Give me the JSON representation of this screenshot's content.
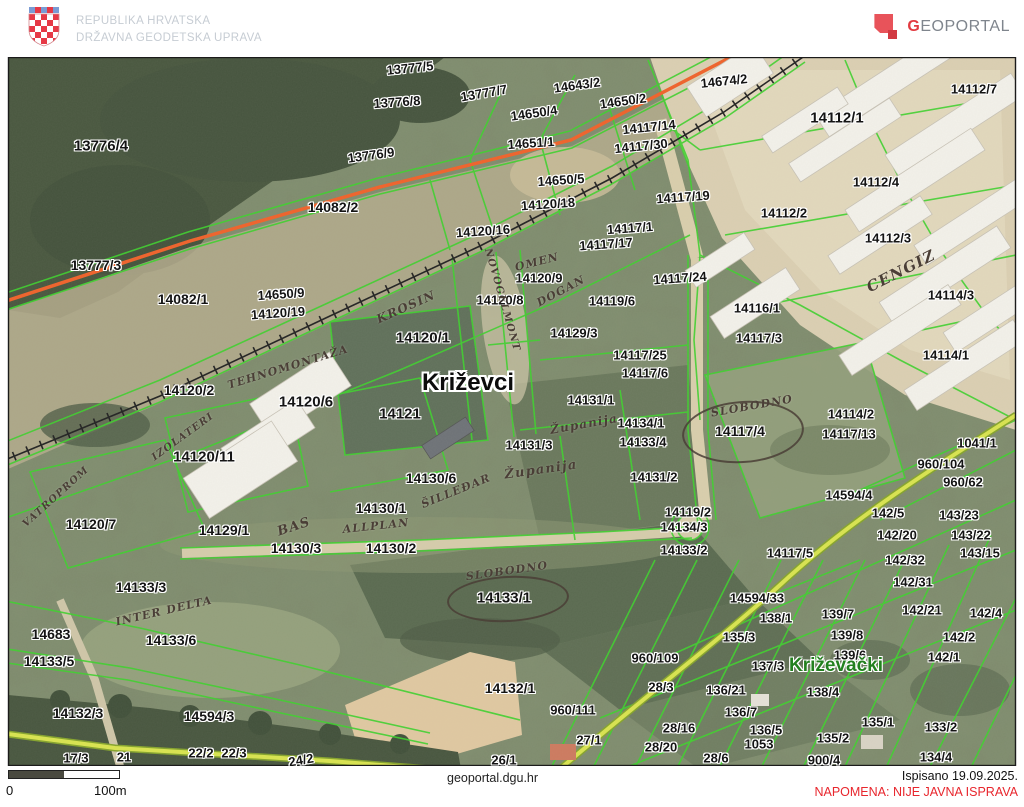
{
  "header": {
    "org_line1": "REPUBLIKA HRVATSKA",
    "org_line2": "DRŽAVNA GEODETSKA UPRAVA",
    "logo_text_leading": "G",
    "logo_text_rest": "EOPORTAL"
  },
  "map": {
    "colors": {
      "parcel_line": "#3fd12e",
      "highlight_road": "#d9e44f",
      "construction_line": "#f0622a",
      "settlement_text": "#23801f",
      "parcel_text": "#141414"
    },
    "labels": [
      {
        "t": "13777/5",
        "x": 410,
        "y": 68,
        "r": -6
      },
      {
        "t": "14643/2",
        "x": 577,
        "y": 85,
        "r": -8
      },
      {
        "t": "14674/2",
        "x": 724,
        "y": 81,
        "r": -6
      },
      {
        "t": "13776/8",
        "x": 397,
        "y": 102,
        "r": -4
      },
      {
        "t": "13777/7",
        "x": 484,
        "y": 93,
        "r": -10
      },
      {
        "t": "14650/4",
        "x": 534,
        "y": 113,
        "r": -8
      },
      {
        "t": "14650/2",
        "x": 623,
        "y": 101,
        "r": -8
      },
      {
        "t": "14112/7",
        "x": 974,
        "y": 89
      },
      {
        "t": "14117/14",
        "x": 649,
        "y": 127,
        "r": -6
      },
      {
        "t": "14112/1",
        "x": 837,
        "y": 118,
        "s": 15
      },
      {
        "t": "14651/1",
        "x": 531,
        "y": 143,
        "r": -4
      },
      {
        "t": "14117/30",
        "x": 641,
        "y": 146,
        "r": -6
      },
      {
        "t": "13776/4",
        "x": 101,
        "y": 146,
        "s": 15
      },
      {
        "t": "13776/9",
        "x": 371,
        "y": 155,
        "r": -8
      },
      {
        "t": "14650/5",
        "x": 561,
        "y": 180,
        "r": -4
      },
      {
        "t": "14112/4",
        "x": 876,
        "y": 182
      },
      {
        "t": "14117/19",
        "x": 683,
        "y": 197,
        "r": -4
      },
      {
        "t": "14082/2",
        "x": 333,
        "y": 207,
        "s": 14
      },
      {
        "t": "14120/18",
        "x": 548,
        "y": 204,
        "r": -4
      },
      {
        "t": "14112/2",
        "x": 784,
        "y": 213
      },
      {
        "t": "14120/16",
        "x": 483,
        "y": 231,
        "r": -4
      },
      {
        "t": "14117/1",
        "x": 630,
        "y": 228,
        "r": -4
      },
      {
        "t": "14112/3",
        "x": 888,
        "y": 238
      },
      {
        "t": "14117/17",
        "x": 606,
        "y": 244,
        "r": -4
      },
      {
        "t": "13777/3",
        "x": 96,
        "y": 265,
        "s": 14
      },
      {
        "t": "14117/24",
        "x": 680,
        "y": 278,
        "r": -4
      },
      {
        "t": "14120/9",
        "x": 539,
        "y": 278
      },
      {
        "t": "14082/1",
        "x": 183,
        "y": 299,
        "s": 14
      },
      {
        "t": "14650/9",
        "x": 281,
        "y": 294,
        "r": -4
      },
      {
        "t": "14120/8",
        "x": 500,
        "y": 300
      },
      {
        "t": "14119/6",
        "x": 612,
        "y": 301
      },
      {
        "t": "14114/3",
        "x": 951,
        "y": 295
      },
      {
        "t": "14120/19",
        "x": 278,
        "y": 313,
        "r": -4
      },
      {
        "t": "14116/1",
        "x": 757,
        "y": 308
      },
      {
        "t": "14129/3",
        "x": 574,
        "y": 333
      },
      {
        "t": "14117/3",
        "x": 759,
        "y": 338
      },
      {
        "t": "14120/1",
        "x": 423,
        "y": 338,
        "s": 15
      },
      {
        "t": "14117/25",
        "x": 640,
        "y": 355
      },
      {
        "t": "14114/1",
        "x": 946,
        "y": 355
      },
      {
        "t": "14117/6",
        "x": 645,
        "y": 373
      },
      {
        "t": "14120/2",
        "x": 189,
        "y": 390,
        "s": 14
      },
      {
        "t": "14120/6",
        "x": 306,
        "y": 402,
        "s": 15
      },
      {
        "t": "14131/1",
        "x": 591,
        "y": 400
      },
      {
        "t": "14121",
        "x": 400,
        "y": 414,
        "s": 15
      },
      {
        "t": "14114/2",
        "x": 851,
        "y": 414
      },
      {
        "t": "14134/1",
        "x": 641,
        "y": 423
      },
      {
        "t": "14117/4",
        "x": 740,
        "y": 431,
        "s": 14
      },
      {
        "t": "14117/13",
        "x": 849,
        "y": 434
      },
      {
        "t": "1041/1",
        "x": 977,
        "y": 443
      },
      {
        "t": "14133/4",
        "x": 643,
        "y": 442
      },
      {
        "t": "14131/3",
        "x": 529,
        "y": 445
      },
      {
        "t": "14120/11",
        "x": 204,
        "y": 457,
        "s": 15
      },
      {
        "t": "960/104",
        "x": 941,
        "y": 464
      },
      {
        "t": "14130/6",
        "x": 431,
        "y": 478,
        "s": 14
      },
      {
        "t": "14131/2",
        "x": 654,
        "y": 477
      },
      {
        "t": "960/62",
        "x": 963,
        "y": 482
      },
      {
        "t": "14594/4",
        "x": 849,
        "y": 495
      },
      {
        "t": "14130/1",
        "x": 381,
        "y": 508,
        "s": 14
      },
      {
        "t": "14119/2",
        "x": 688,
        "y": 512
      },
      {
        "t": "142/5",
        "x": 888,
        "y": 513
      },
      {
        "t": "143/23",
        "x": 959,
        "y": 515
      },
      {
        "t": "14120/7",
        "x": 91,
        "y": 524,
        "s": 14
      },
      {
        "t": "14134/3",
        "x": 684,
        "y": 527
      },
      {
        "t": "14129/1",
        "x": 224,
        "y": 530,
        "s": 14
      },
      {
        "t": "142/20",
        "x": 897,
        "y": 535
      },
      {
        "t": "143/22",
        "x": 971,
        "y": 535
      },
      {
        "t": "14130/3",
        "x": 296,
        "y": 548,
        "s": 14
      },
      {
        "t": "14130/2",
        "x": 391,
        "y": 548,
        "s": 14
      },
      {
        "t": "14133/2",
        "x": 684,
        "y": 550
      },
      {
        "t": "143/15",
        "x": 980,
        "y": 553
      },
      {
        "t": "14117/5",
        "x": 790,
        "y": 553
      },
      {
        "t": "142/32",
        "x": 905,
        "y": 560
      },
      {
        "t": "14133/3",
        "x": 141,
        "y": 587,
        "s": 14
      },
      {
        "t": "142/31",
        "x": 913,
        "y": 582
      },
      {
        "t": "14133/1",
        "x": 504,
        "y": 598,
        "s": 15
      },
      {
        "t": "14594/33",
        "x": 757,
        "y": 598
      },
      {
        "t": "139/7",
        "x": 838,
        "y": 614
      },
      {
        "t": "142/21",
        "x": 922,
        "y": 610
      },
      {
        "t": "142/4",
        "x": 986,
        "y": 613
      },
      {
        "t": "138/1",
        "x": 776,
        "y": 618
      },
      {
        "t": "14683",
        "x": 51,
        "y": 634,
        "s": 14
      },
      {
        "t": "135/3",
        "x": 739,
        "y": 637
      },
      {
        "t": "139/8",
        "x": 847,
        "y": 635
      },
      {
        "t": "142/2",
        "x": 959,
        "y": 637
      },
      {
        "t": "14133/6",
        "x": 171,
        "y": 640,
        "s": 14
      },
      {
        "t": "139/6",
        "x": 850,
        "y": 655
      },
      {
        "t": "960/109",
        "x": 655,
        "y": 658
      },
      {
        "t": "142/1",
        "x": 944,
        "y": 657
      },
      {
        "t": "14133/5",
        "x": 49,
        "y": 661,
        "s": 14
      },
      {
        "t": "137/3",
        "x": 768,
        "y": 666
      },
      {
        "t": "28/3",
        "x": 661,
        "y": 687
      },
      {
        "t": "14132/1",
        "x": 510,
        "y": 688,
        "s": 14
      },
      {
        "t": "136/21",
        "x": 726,
        "y": 690
      },
      {
        "t": "138/4",
        "x": 823,
        "y": 692
      },
      {
        "t": "960/111",
        "x": 573,
        "y": 710
      },
      {
        "t": "136/7",
        "x": 741,
        "y": 712
      },
      {
        "t": "14132/3",
        "x": 78,
        "y": 713,
        "s": 14
      },
      {
        "t": "14594/3",
        "x": 209,
        "y": 716,
        "s": 14
      },
      {
        "t": "135/1",
        "x": 878,
        "y": 722
      },
      {
        "t": "28/16",
        "x": 679,
        "y": 728
      },
      {
        "t": "136/5",
        "x": 766,
        "y": 730
      },
      {
        "t": "133/2",
        "x": 941,
        "y": 727
      },
      {
        "t": "135/2",
        "x": 833,
        "y": 738
      },
      {
        "t": "1053",
        "x": 759,
        "y": 744
      },
      {
        "t": "27/1",
        "x": 589,
        "y": 740
      },
      {
        "t": "28/20",
        "x": 661,
        "y": 747
      },
      {
        "t": "26/1",
        "x": 504,
        "y": 760
      },
      {
        "t": "17/3",
        "x": 76,
        "y": 758
      },
      {
        "t": "21",
        "x": 124,
        "y": 757
      },
      {
        "t": "22/2",
        "x": 201,
        "y": 753
      },
      {
        "t": "22/3",
        "x": 234,
        "y": 753
      },
      {
        "t": "28/6",
        "x": 716,
        "y": 758
      },
      {
        "t": "24/2",
        "x": 301,
        "y": 760,
        "r": -10
      },
      {
        "t": "900/4",
        "x": 824,
        "y": 760
      },
      {
        "t": "134/4",
        "x": 936,
        "y": 757
      },
      {
        "t": "Križevci",
        "x": 468,
        "y": 383,
        "s": 24,
        "k": "town"
      },
      {
        "t": "Križevački",
        "x": 836,
        "y": 666,
        "s": 19,
        "k": "settlement"
      },
      {
        "t": "CENGIZ",
        "x": 901,
        "y": 271,
        "r": -27,
        "s": 15,
        "k": "hand"
      },
      {
        "t": "OMEN",
        "x": 537,
        "y": 262,
        "r": -14,
        "s": 11,
        "k": "hand"
      },
      {
        "t": "DOGAN",
        "x": 561,
        "y": 291,
        "r": -28,
        "s": 11,
        "k": "hand"
      },
      {
        "t": "NOVOGELMONT",
        "x": 502,
        "y": 300,
        "r": 74,
        "s": 10,
        "k": "hand"
      },
      {
        "t": "KROSIN",
        "x": 406,
        "y": 307,
        "r": -24,
        "s": 12,
        "k": "hand"
      },
      {
        "t": "TEHNOMONTAŽA",
        "x": 288,
        "y": 367,
        "r": -17,
        "s": 11,
        "k": "hand"
      },
      {
        "t": "IZOLATERI",
        "x": 183,
        "y": 437,
        "r": -36,
        "s": 10,
        "k": "hand"
      },
      {
        "t": "VATROPROM",
        "x": 56,
        "y": 497,
        "r": -42,
        "s": 10,
        "k": "hand"
      },
      {
        "t": "Županija",
        "x": 584,
        "y": 424,
        "r": -10,
        "s": 12,
        "k": "hand"
      },
      {
        "t": "Županija",
        "x": 541,
        "y": 470,
        "r": -8,
        "s": 13,
        "k": "hand"
      },
      {
        "t": "ŠILLEĐAR",
        "x": 456,
        "y": 491,
        "r": -22,
        "s": 11,
        "k": "hand"
      },
      {
        "t": "BAS",
        "x": 294,
        "y": 527,
        "r": -18,
        "s": 13,
        "k": "hand"
      },
      {
        "t": "ALLPLAN",
        "x": 376,
        "y": 526,
        "r": -6,
        "s": 11,
        "k": "hand"
      },
      {
        "t": "SLOBODNO",
        "x": 752,
        "y": 406,
        "r": -10,
        "s": 11,
        "k": "hand"
      },
      {
        "t": "SLOBODNO",
        "x": 507,
        "y": 571,
        "r": -8,
        "s": 11,
        "k": "hand"
      },
      {
        "t": "INTER DELTA",
        "x": 164,
        "y": 611,
        "r": -13,
        "s": 11,
        "k": "hand"
      }
    ],
    "circles": [
      {
        "x": 741,
        "y": 430,
        "w": 118,
        "h": 58,
        "r": -4
      },
      {
        "x": 506,
        "y": 597,
        "w": 118,
        "h": 42,
        "r": -3
      }
    ]
  },
  "footer": {
    "scale_start": "0",
    "scale_end": "100m",
    "source_url": "geoportal.dgu.hr",
    "printed_date": "Ispisano 19.09.2025.",
    "warning": "NAPOMENA: NIJE JAVNA ISPRAVA"
  }
}
